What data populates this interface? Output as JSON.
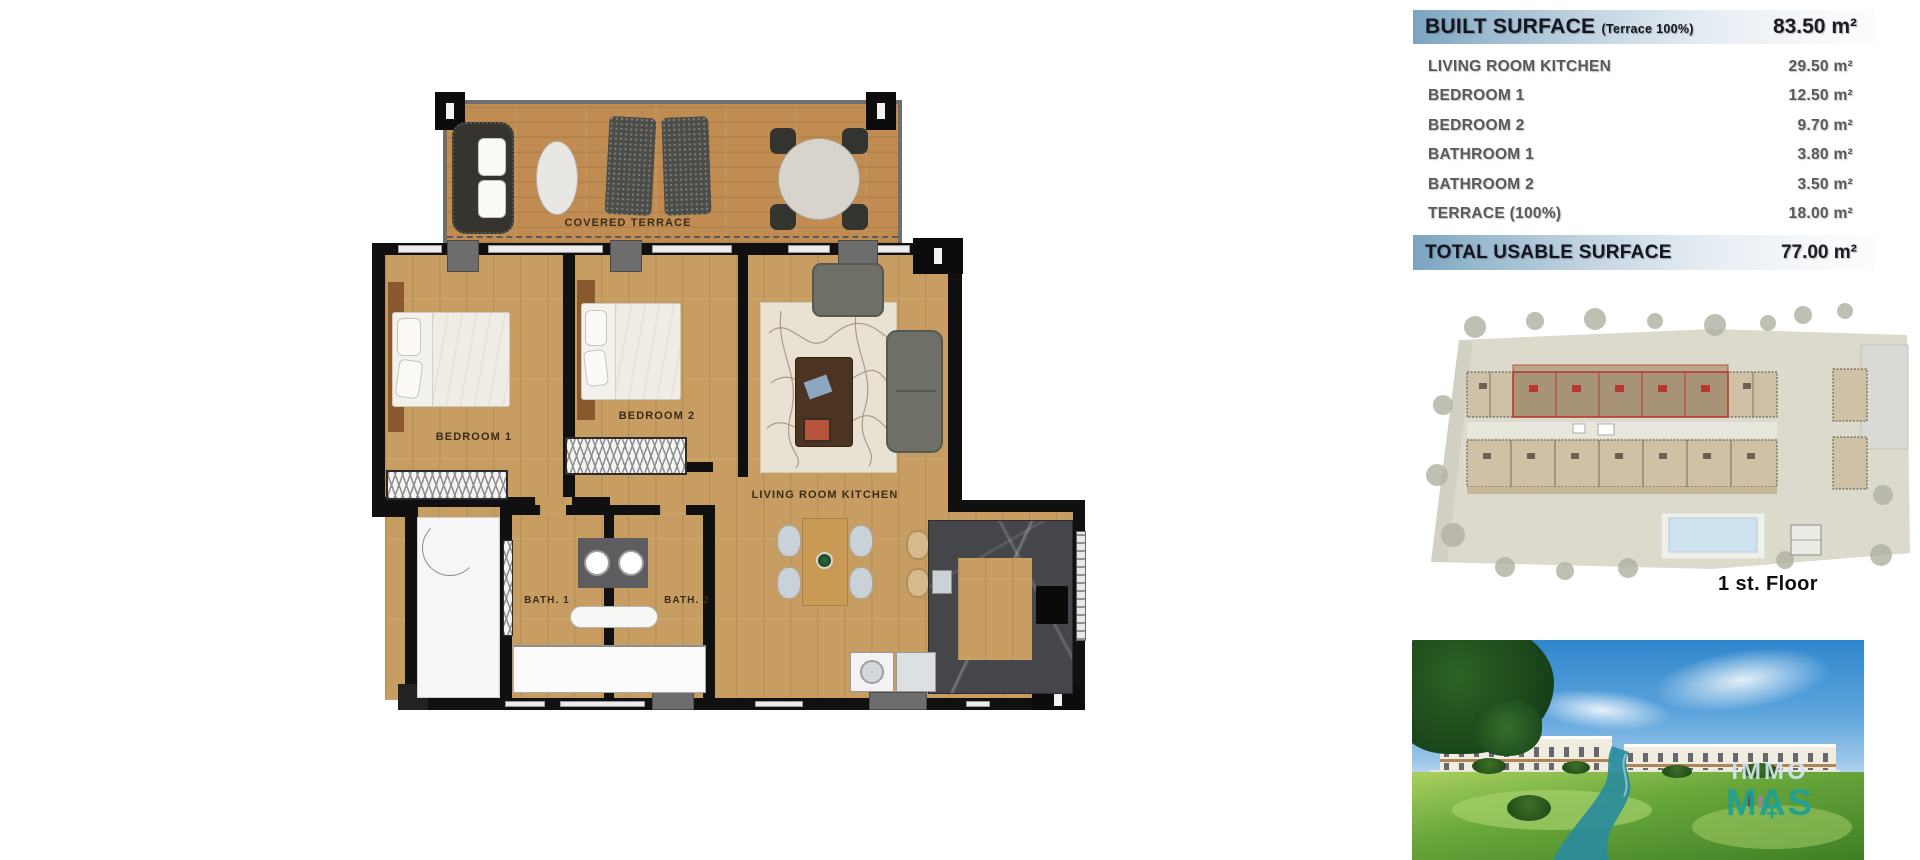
{
  "surface_table": {
    "header": {
      "label": "BUILT SURFACE",
      "sublabel": "(Terrace 100%)",
      "value": "83.50 m²"
    },
    "rows": [
      {
        "label": "LIVING ROOM KITCHEN",
        "value": "29.50 m²"
      },
      {
        "label": "BEDROOM 1",
        "value": "12.50 m²"
      },
      {
        "label": "BEDROOM 2",
        "value": "9.70 m²"
      },
      {
        "label": "BATHROOM 1",
        "value": "3.80 m²"
      },
      {
        "label": "BATHROOM 2",
        "value": "3.50 m²"
      },
      {
        "label": "TERRACE (100%)",
        "value": "18.00 m²"
      }
    ],
    "footer": {
      "label": "TOTAL USABLE SURFACE",
      "value": "77.00 m²"
    }
  },
  "floor_plan": {
    "labels": {
      "covered_terrace": "COVERED TERRACE",
      "bedroom_1": "BEDROOM 1",
      "bedroom_2": "BEDROOM 2",
      "living_room_kitchen": "LIVING ROOM KITCHEN",
      "bath_1": "BATH. 1",
      "bath_2": "BATH. 2"
    }
  },
  "site_plan": {
    "caption": "1 st. Floor"
  },
  "photo": {
    "watermark": {
      "line1": "IMMO",
      "line2": "MAS",
      "plus": "+"
    }
  },
  "colors": {
    "table_band_blue": "#7ba3c0",
    "site_highlight_red": "#b8382e",
    "watermark_teal": "#1e9e98",
    "wood_floor": "#c79d62"
  }
}
